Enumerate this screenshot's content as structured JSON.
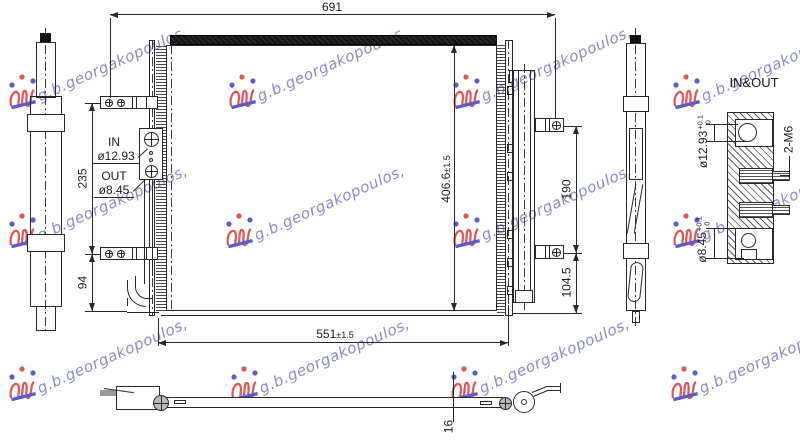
{
  "watermark": {
    "text": "g.b.georgakopoulos,"
  },
  "views": {
    "front": {
      "dim_width_top": "691",
      "dim_width_bottom": "551",
      "dim_width_bottom_tol": "±1.5",
      "dim_height": "406.6",
      "dim_height_tol": "±1.5",
      "dim_left_upper": "235",
      "dim_left_lower": "94",
      "dim_right_upper": "190",
      "dim_right_lower": "104.5",
      "port_in_label": "IN",
      "port_in_dia": "ø12.93",
      "port_out_label": "OUT",
      "port_out_dia": "ø8.45"
    },
    "detail": {
      "title": "IN&OUT",
      "port_in_dia": "ø12.93",
      "port_in_tol_plus": "+0.1",
      "port_in_tol_base": "0",
      "bolt_spec": "2-M6",
      "port_out_dia": "ø8.45",
      "port_out_tol_plus": "+0.1",
      "port_out_tol_base": "0"
    },
    "bottom": {
      "dim_thickness": "16"
    }
  },
  "colors": {
    "line": "#282828",
    "watermark_text": "#7d7dc6",
    "logo_red": "#e05555",
    "logo_blue": "#5c5cc8",
    "core_bar": "#161616"
  }
}
